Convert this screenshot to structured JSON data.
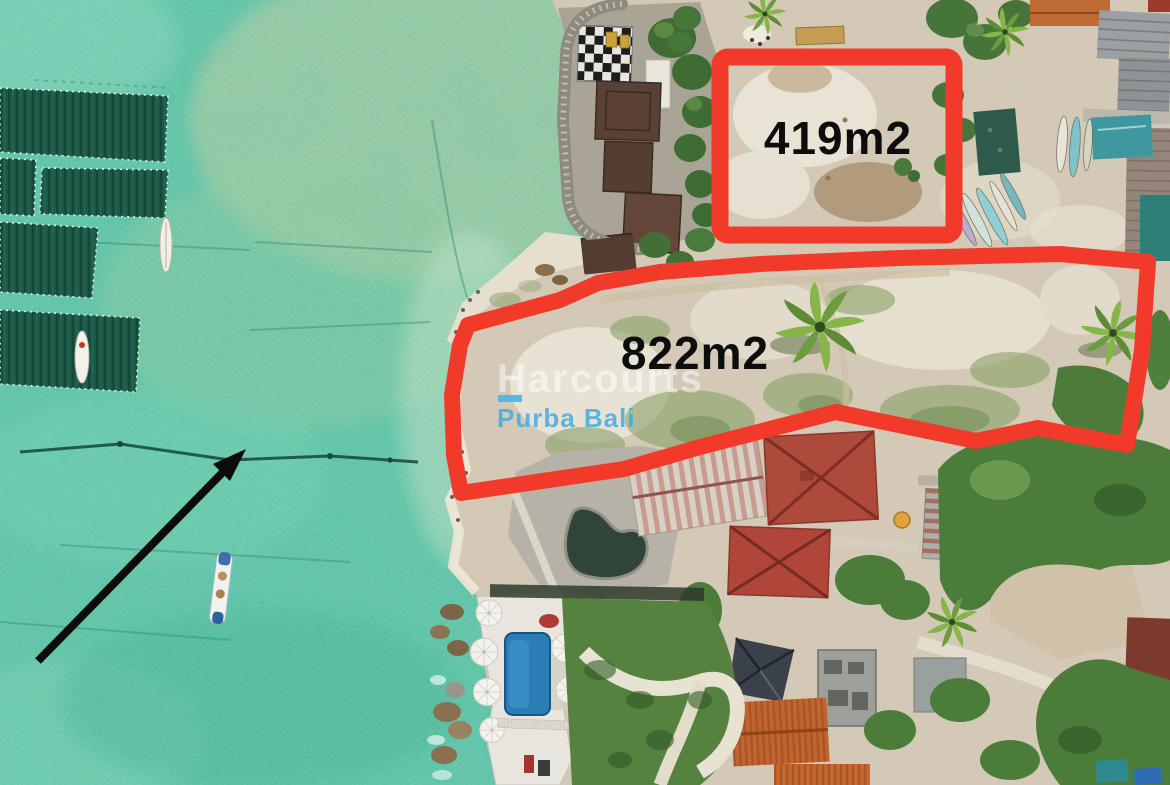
{
  "meta": {
    "type": "annotated aerial drone photograph",
    "subject": "beachfront vacant land plots outlined in red beside turquoise sea"
  },
  "annotations": {
    "plots": [
      {
        "name": "small-plot",
        "label": "419m2",
        "area_m2": 419,
        "shape": "rectangle",
        "outline_color": "#f23a2b"
      },
      {
        "name": "large-plot",
        "label": "822m2",
        "area_m2": 822,
        "shape": "polygon",
        "outline_color": "#f23a2b"
      }
    ],
    "arrow": {
      "color": "#0c0c0c",
      "direction": "pointing northeast toward the shoreline"
    },
    "watermark": {
      "line1": "Harcourts",
      "line2": "Purba Bali",
      "line1_color": "#ffffff",
      "line2_color": "#3aa9e0"
    },
    "label_text_color": "#0d0d0d"
  },
  "scene": {
    "water_color": "#5fc4a8",
    "sand_color": "#d3c9b6",
    "vegetation_color": "#4c7c3a",
    "features": [
      "turquoise shallow sea with dark seaweed-farm plots",
      "three small boats on the water",
      "white sand beach and stone seawall",
      "temple compound with dark tiled roofs",
      "two vacant land plots outlined in red",
      "villa with blue swimming pool and white umbrellas",
      "red, orange and tin roofs of village buildings",
      "palm trees and stored kayaks"
    ]
  }
}
